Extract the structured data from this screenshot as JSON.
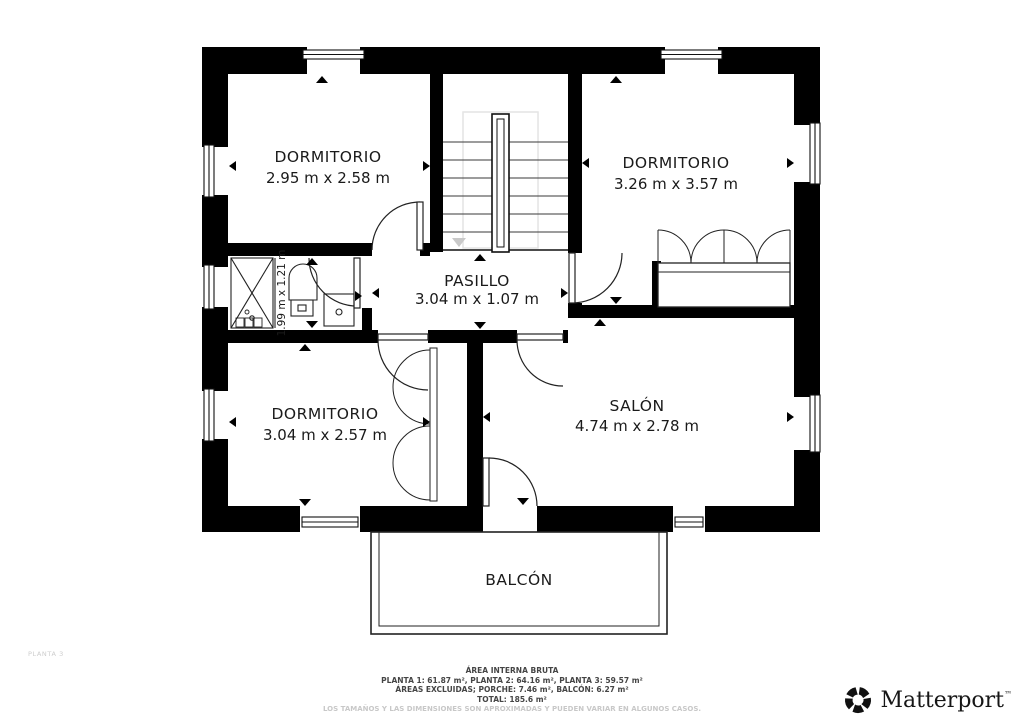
{
  "floor_plan": {
    "floor_label": "PLANTA 3",
    "rooms": [
      {
        "name": "DORMITORIO",
        "dims": "2.95 m x 2.58 m"
      },
      {
        "name": "DORMITORIO",
        "dims": "3.26 m x 3.57 m"
      },
      {
        "name": "PASILLO",
        "dims": "3.04 m x 1.07 m"
      },
      {
        "name": "DORMITORIO",
        "dims": "3.04 m x 2.57 m"
      },
      {
        "name": "SALÓN",
        "dims": "4.74 m x 2.78 m"
      },
      {
        "name": "BALCÓN",
        "dims": ""
      }
    ],
    "bathroom_dims": "1.99 m x 1.21 m"
  },
  "footer": {
    "area_title": "ÁREA INTERNA BRUTA",
    "plants": "PLANTA 1: 61.87 m², PLANTA 2: 64.16 m², PLANTA 3: 59.57 m²",
    "excluded": "ÁREAS EXCLUIDAS; PORCHE: 7.46 m², BALCÓN: 6.27 m²",
    "total": "TOTAL: 185.6 m²",
    "disclaimer": "LOS TAMAÑOS Y LAS DIMENSIONES SON APROXIMADAS Y PUEDEN VARIAR EN ALGUNOS CASOS."
  },
  "branding": {
    "name": "Matterport",
    "trademark": "™"
  },
  "colors": {
    "wall": "#000000",
    "line": "#1a1a1a",
    "guide": "#e2e2e2",
    "muted": "#c8c8c8",
    "footer_text": "#454545"
  }
}
